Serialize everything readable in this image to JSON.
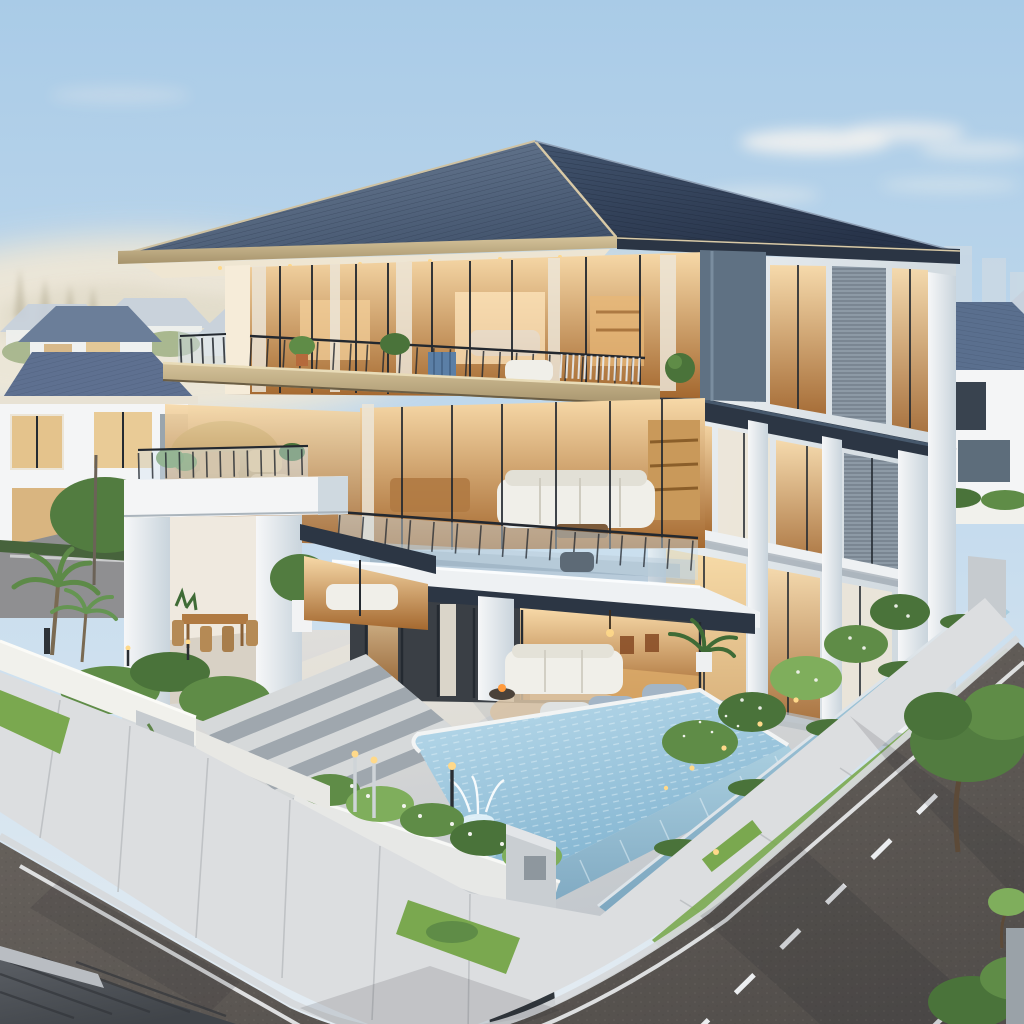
{
  "alt": "Photorealistic golden-hour rendering of a modern three-story villa with a dark slate hip roof, warm-lit glass facades, stacked balconies, a white portal pavilion with roof terrace, landscaped garden, infinity pool with fountain, and an asphalt street with lane markings curving around the corner lot; neighboring suburban houses and a hazy skyline in the distance.",
  "palette": {
    "skyTop": "#a9cbe7",
    "skyMid": "#c8ddee",
    "skyLow": "#e4ecf2",
    "haze": "#f4e9d4",
    "cloud": "#f7f5f0",
    "mountain": "#dcd6c3",
    "pine": "#b7b098",
    "farRoof": "#c7d1dd",
    "farWall": "#eff1f0",
    "farGreen": "#a3b489",
    "city": "#ccd9e4",
    "roofLeft1": "#71839b",
    "roofLeft2": "#42536c",
    "roofRight1": "#42546e",
    "roofRight2": "#273349",
    "ridgeCap": "#d8c9a6",
    "fasciaCream": "#d2c199",
    "fasciaDark": "#2b3544",
    "soffit": "#efe6d2",
    "facadeWhite": "#f4f5f6",
    "facadeWarm": "#f6ecd9",
    "facadeShade": "#ccd5dc",
    "pierSlate": "#5f7183",
    "slabTan1": "#d6c49b",
    "slabTan2": "#a6936c",
    "slabWhite": "#eef1f3",
    "slabCharcoal": "#2c3644",
    "frameDark": "#242a31",
    "glassBright": "#f7d9a8",
    "glassWarm2": "#a4682f",
    "curtain": "#ece5d7",
    "glassCool": "#bdd2e0",
    "slatGray": "#8d9aa6",
    "railDark": "#23282f",
    "planterBlue": "#5b7fa6",
    "sofaWhite": "#f0efe9",
    "chairBlue": "#a3b5c6",
    "woodFloor": "#d9a968",
    "woodTable": "#b07a42",
    "shelfWarm": "#c9995a",
    "terrace1": "#e2e0dc",
    "terrace2": "#c3c8cd",
    "stairTread": "#d6d9da",
    "stairShadow": "#9fa7ae",
    "poolLight": "#bcdcec",
    "poolDeep": "#7fb2cf",
    "weir1": "#aacfe0",
    "weir2": "#7ca6bf",
    "coping": "#f2f4f4",
    "grass": "#7aa84f",
    "shrubDark": "#4a733a",
    "shrubMid": "#5f8c47",
    "shrubLight": "#7fae5c",
    "flowerWhite": "#f2f4ee",
    "palmGreen": "#5d8a48",
    "treeGreen": "#527c40",
    "wallWhiteP": "#f1f1ec",
    "wallGray": "#c6cbcf",
    "retWall1": "#c3ccd4",
    "retWall2": "#98a5b0",
    "gateDark": "#30363c",
    "sidewalk": "#dcdee0",
    "joint": "#b9bcbf",
    "curb": "#d6d9db",
    "road1": "#6e6862",
    "road2": "#524e4b",
    "marking": "#eceef0",
    "shadow": "#20242a",
    "metalRoof1": "#5c6066",
    "metalRoof2": "#404449",
    "trunk": "#5c4a38",
    "lampWarm": "#ffd98a",
    "fire": "#ff9b3d",
    "chrome": "#cfd4d8"
  },
  "scene": {
    "time_of_day": "golden hour, warm interior lighting",
    "view": "elevated three-quarter aerial view of a corner lot",
    "sky": {
      "condition": "clear with thin wispy clouds right of the roof",
      "horizon": "warm cream haze over distant rooftops on the left"
    },
    "background": {
      "left": "hazy ridge line, faint pines, rows of pale hip-roofed suburban houses among trees",
      "left_neighbor_house": "white two-story house with blue-gray hip roofs, tan curtained windows, gray accent panel",
      "right_neighbor_house": "white two-story house with blue-gray hip roof, dark picture windows, low white fence and hedge",
      "skyline": "two faint high-rise towers far right",
      "side_street": "secondary street behind the left garden wall with palms and street trees"
    },
    "main_house": {
      "roof": "dark blue-slate hip roof, fine shingle courses, cream fascia and lit soffit on the left eave, charcoal fascia on the right",
      "top_floor": "full-height glass with black mullions, white sheer curtains, warm-lit bedroom and lounge, long balcony with black railing, potted plants, blue planter box, white sofa, slate corner pier",
      "middle_floor": "open-plan living room behind glass: white sectional sofa, wood coffee table, lit bookshelf, dining table; front glass-railed terrace with patterned rug; tan floor slab band above, white slab with charcoal fascia below",
      "ground_floor": "covered outdoor lounge with white sofa, blue-gray armchairs, chaise, round rug and fire bowl; warm wood-floored interior behind sliding glass; white structural column",
      "right_wing": "three stacked levels of tall vertical glazing with warm light, white pilasters, gray louvre panels, charcoal floor bands, bright lit ground-floor window"
    },
    "pavilion": "detached white portal frame beside the house; roof terrace with glass-and-steel railing and plants; shaded dining terrace below with wooden table, chairs, potted tree and aloe; gray planter base",
    "outdoor": {
      "pool": "infinity pool with pale tiled water, white coping, rippled overflow weir wall facing the street, white fountain jets and splash",
      "stairs": {
        "steps": 8,
        "description": "wide concrete steps from the street level up to the main terrace"
      },
      "planters": "low white planter walls full of white-flowering shrubs and grasses along the frontage",
      "lighting": "chrome and black bollard lamps, warm garden ground lights, tiny fairy lights in the right planting bed",
      "lawn": "bright green verge strips and garden beds"
    },
    "street": {
      "road": "dark asphalt curving around the corner, one solid white edge line, two dashed lane lines, long diagonal shadows",
      "sidewalk": "light concrete walk with expansion joints and grass verge wrapping the corner",
      "gate": "gray gate pillar with inset panel and dark slatted screen near the pool corner",
      "foreground": "dark ribbed metal roof of a house across the street in the bottom-left corner; street tree, sapling, hedges and gray pillar at the right edge"
    }
  }
}
